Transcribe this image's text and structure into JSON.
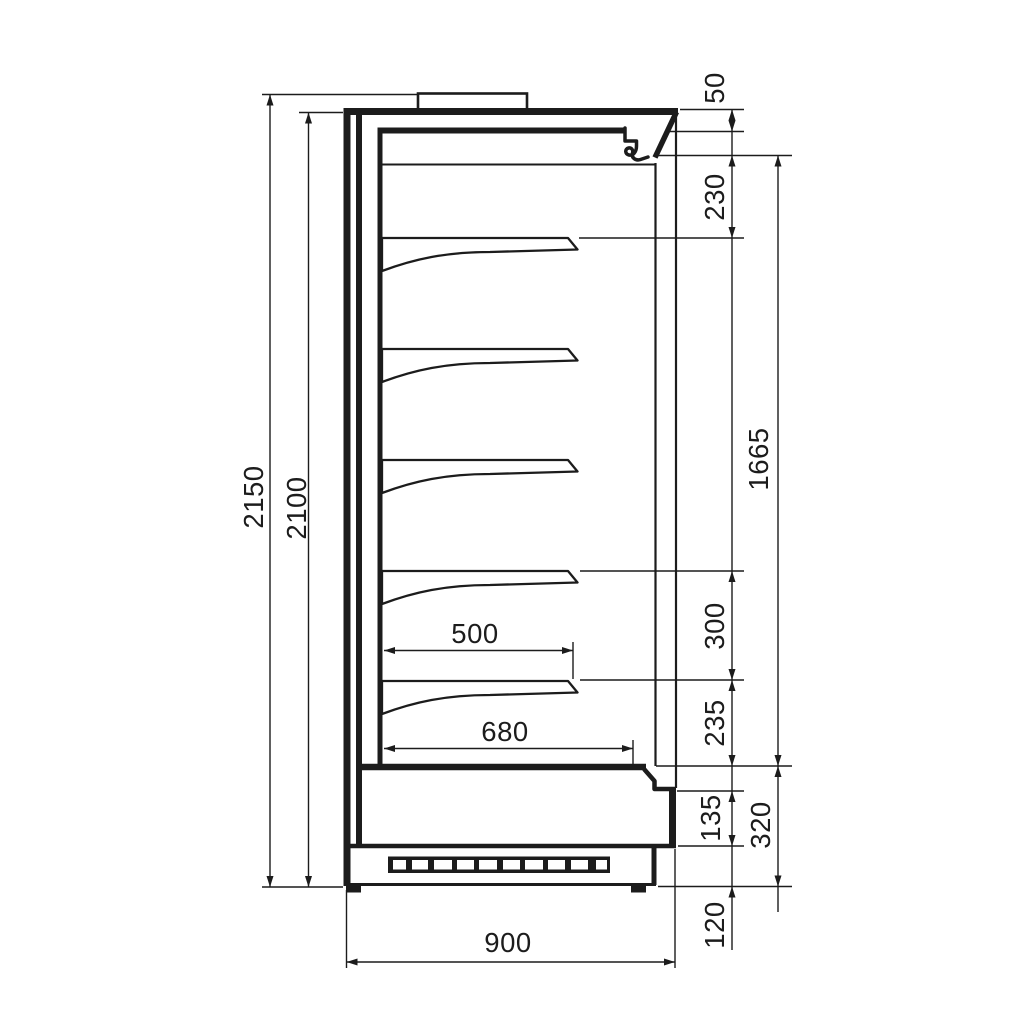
{
  "drawing": {
    "type": "technical-drawing",
    "view": "side-section",
    "subject": "refrigerated multideck display cabinet",
    "units": "mm",
    "line_color": "#1c1c1c",
    "background": "#ffffff"
  },
  "dims": {
    "d2150": "2150",
    "d2100": "2100",
    "d50": "50",
    "d230": "230",
    "d1665": "1665",
    "d300": "300",
    "d235": "235",
    "d135": "135",
    "d320": "320",
    "d120": "120",
    "d500": "500",
    "d680": "680",
    "d900": "900"
  }
}
